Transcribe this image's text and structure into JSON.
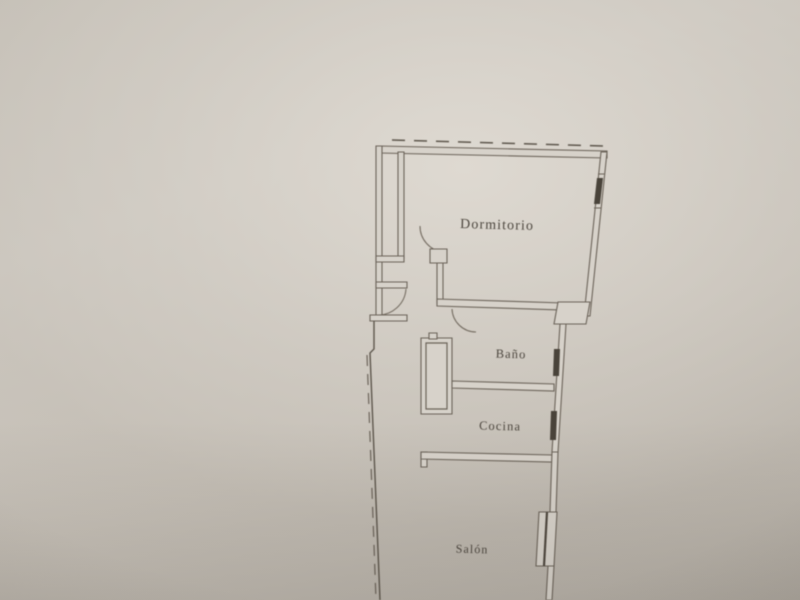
{
  "photo": {
    "kind": "photographed floor plan on paper",
    "paper_color": "#d7d2ca",
    "line_color": "#6b6359",
    "window_mark_color": "#49433a",
    "label_color": "#4c463e"
  },
  "floor_plan": {
    "rooms": [
      {
        "id": "dormitorio",
        "label": "Dormitorio"
      },
      {
        "id": "bano",
        "label": "Baño"
      },
      {
        "id": "cocina",
        "label": "Cocina"
      },
      {
        "id": "salon",
        "label": "Salón"
      }
    ]
  }
}
